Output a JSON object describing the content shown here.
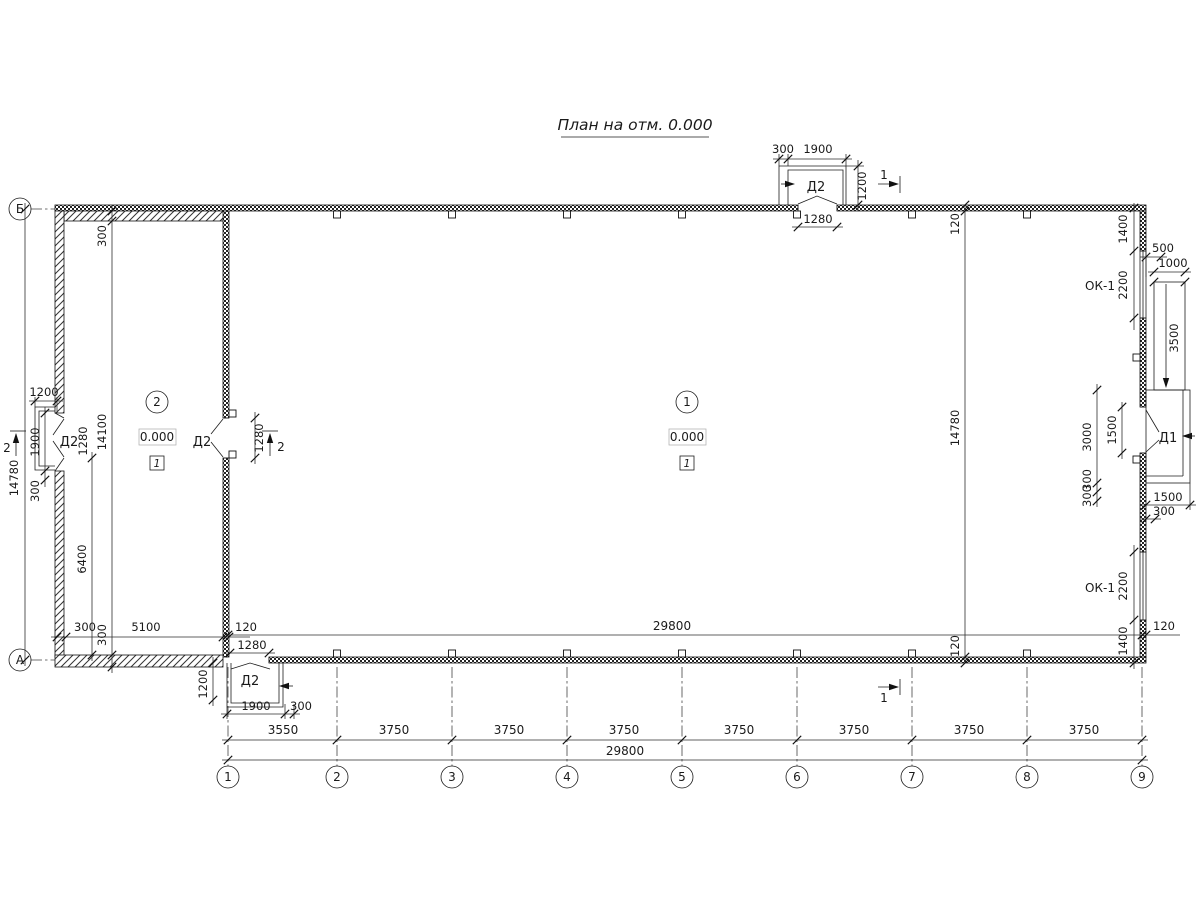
{
  "title": "План на отм. 0.000",
  "grid": {
    "columns": [
      "1",
      "2",
      "3",
      "4",
      "5",
      "6",
      "7",
      "8",
      "9"
    ],
    "rows": {
      "top": "Б",
      "bottom": "А"
    },
    "bays": [
      "3550",
      "3750",
      "3750",
      "3750",
      "3750",
      "3750",
      "3750",
      "3750"
    ],
    "overall_width": "29800"
  },
  "rooms": {
    "room1": {
      "number": "1",
      "level": "0.000",
      "floor": "1"
    },
    "room2": {
      "number": "2",
      "level": "0.000",
      "floor": "1"
    }
  },
  "openings": {
    "d1": "Д1",
    "d2": "Д2",
    "ok1": "ОК-1"
  },
  "sections": {
    "one": "1",
    "two": "2"
  },
  "dims": {
    "int_width": "29800",
    "int_wall_top": "120",
    "int_height": "14780",
    "int_wall_bottom": "120",
    "left_outer_height": "14780",
    "left_vest_width": "1200",
    "left_door_outer": "1900",
    "left_door_jamb": "300",
    "left_door_opening": "1280",
    "annex_inner_height": "14100",
    "annex_wall_top": "300",
    "annex_wall_bottom": "300",
    "annex_lower_height": "6400",
    "bl_wall": "300",
    "bl_width": "5100",
    "bl_gap": "120",
    "partition_opening": "1280",
    "top_door_jamb": "300",
    "top_door_outer": "1900",
    "top_vest_depth": "1200",
    "top_door_opening": "1280",
    "tr_corner": "1400",
    "tr_window": "2200",
    "ramp_offset": "500",
    "ramp_width": "1000",
    "ramp_length": "3500",
    "landing_length": "3000",
    "d1_opening": "1500",
    "d1_jamb_a": "300",
    "d1_jamb_b": "300",
    "landing_width": "1500",
    "landing_edge": "300",
    "br_window": "2200",
    "br_corner": "1400",
    "br_gap": "120",
    "bot_door_opening": "1280",
    "bot_vest_depth": "1200",
    "bot_door_outer": "1900",
    "bot_door_jamb": "300"
  }
}
